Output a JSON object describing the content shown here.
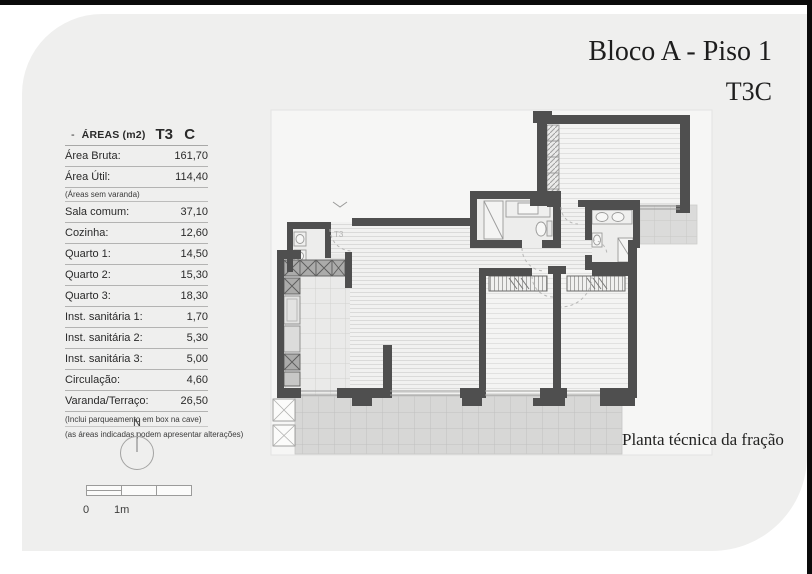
{
  "page": {
    "title_line1": "Bloco A - Piso 1",
    "title_line2": "T3C",
    "caption": "Planta técnica da fração"
  },
  "areas_table": {
    "header": {
      "prefix": "-",
      "title": "ÁREAS (m2)",
      "unit_type": "T3 C"
    },
    "summary_rows": [
      {
        "label": "Área Bruta:",
        "value": "161,70"
      },
      {
        "label": "Área Útil:",
        "value": "114,40"
      }
    ],
    "summary_note": "(Áreas sem varanda)",
    "detail_rows": [
      {
        "label": "Sala comum:",
        "value": "37,10"
      },
      {
        "label": "Cozinha:",
        "value": "12,60"
      },
      {
        "label": "Quarto 1:",
        "value": "14,50"
      },
      {
        "label": "Quarto 2:",
        "value": "15,30"
      },
      {
        "label": "Quarto 3:",
        "value": "18,30"
      },
      {
        "label": "Inst. sanitária 1:",
        "value": "1,70"
      },
      {
        "label": "Inst. sanitária 2:",
        "value": "5,30"
      },
      {
        "label": "Inst. sanitária 3:",
        "value": "5,00"
      },
      {
        "label": "Circulação:",
        "value": "4,60"
      },
      {
        "label": "Varanda/Terraço:",
        "value": "26,50"
      }
    ],
    "footnotes": [
      "(Inclui parqueamento em box na cave)",
      "(as áreas indicadas podem apresentar alterações)"
    ]
  },
  "floor_plan": {
    "entry_label": "T3"
  },
  "compass": {
    "label": "N"
  },
  "scale_bar": {
    "zero": "0",
    "one": "1m"
  },
  "colors": {
    "wall": "#4f4f4f",
    "card_bg": "#efefee",
    "frame": "#0b0b0b"
  }
}
